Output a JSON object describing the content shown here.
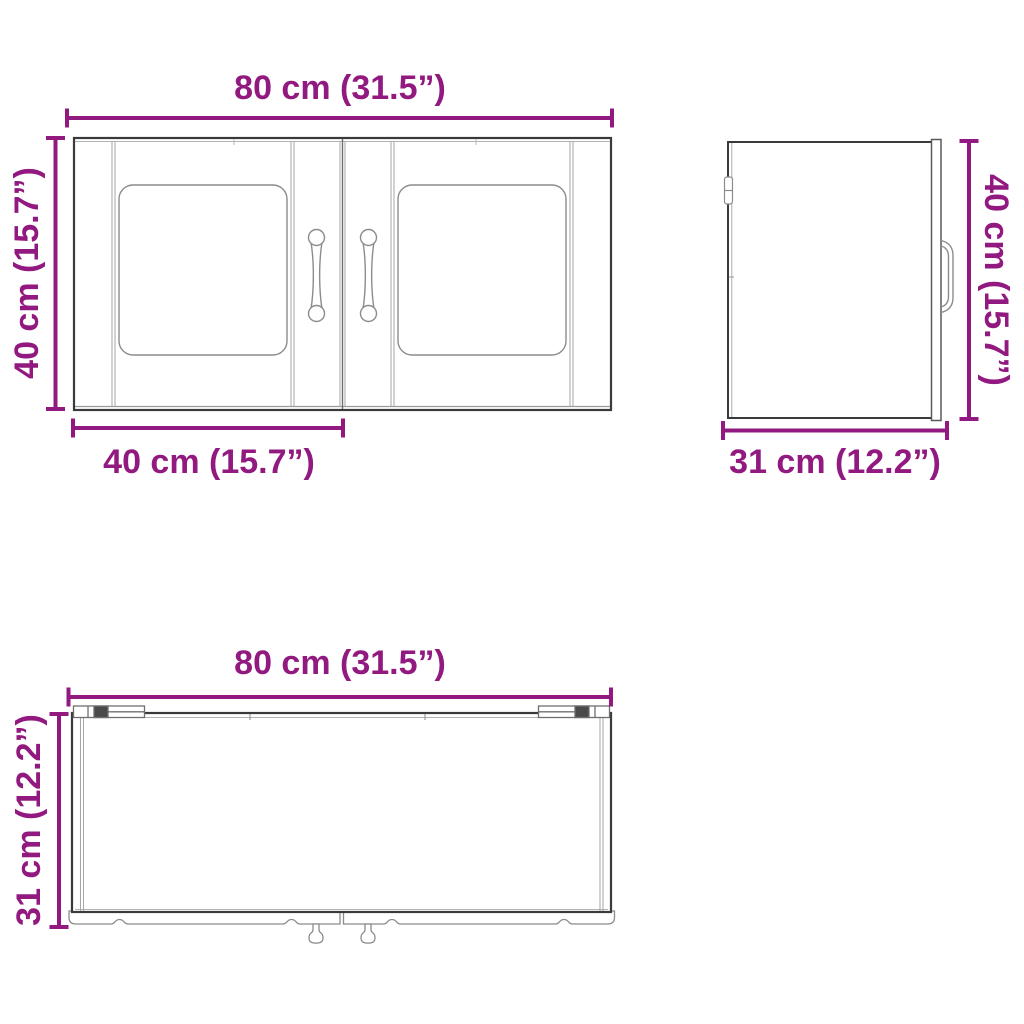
{
  "diagram": {
    "colors": {
      "dimension": "#91197f",
      "line_art": "#3a3a3a",
      "detail_line": "#8c8c8c",
      "background": "#ffffff"
    },
    "views": {
      "front": {
        "width": "80 cm (31.5”)",
        "height": "40 cm (15.7”)",
        "door_width": "40 cm (15.7”)"
      },
      "side": {
        "height": "40 cm (15.7”)",
        "depth": "31 cm (12.2”)"
      },
      "top": {
        "width": "80 cm (31.5”)",
        "depth": "31 cm (12.2”)"
      }
    }
  }
}
